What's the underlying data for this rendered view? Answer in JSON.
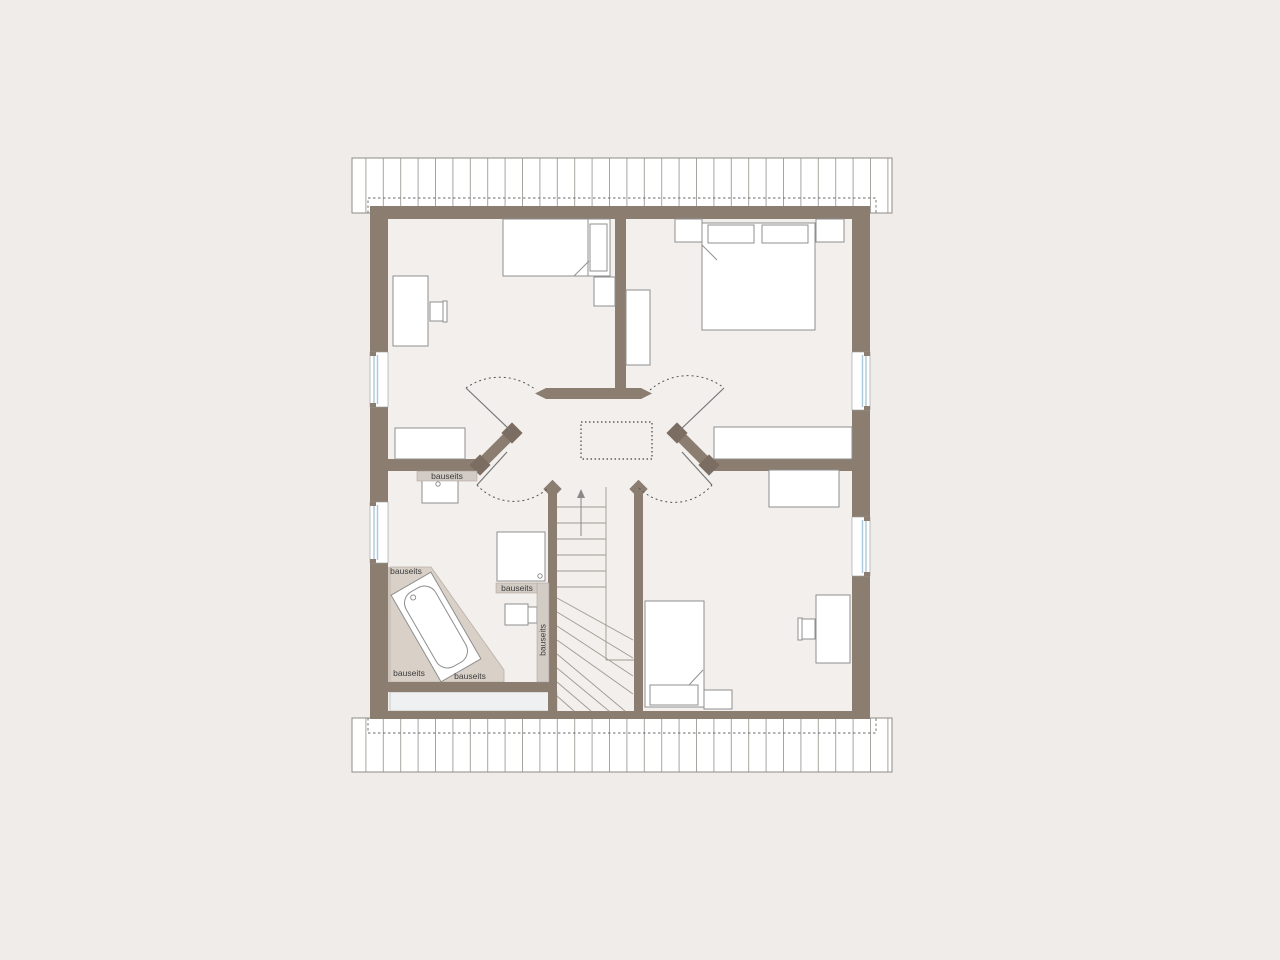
{
  "annotations": [
    {
      "text": "bauseits",
      "location": "shelf-under-left-room-wall",
      "orientation": "horizontal"
    },
    {
      "text": "bauseits",
      "location": "bathroom-left-knee-wall-top",
      "orientation": "horizontal"
    },
    {
      "text": "bauseits",
      "location": "band-under-shower",
      "orientation": "horizontal"
    },
    {
      "text": "bauseits",
      "location": "bathroom-right-duct",
      "orientation": "vertical"
    },
    {
      "text": "bauseits",
      "location": "bathroom-bottom-left",
      "orientation": "horizontal"
    },
    {
      "text": "bauseits",
      "location": "bathroom-bottom-center",
      "orientation": "horizontal"
    }
  ],
  "colors": {
    "background": "#f0ece9",
    "floor": "#f2efec",
    "wall": "#8b7d70",
    "knob": "#7b6d61",
    "knee": "#d9d1c8",
    "band": "#d3ccc5",
    "lining": "#cdc3b8",
    "glass": "#a9c9db",
    "outline": "#8f8f8f",
    "stair_line": "#a39a91",
    "text": "#3b3b3b"
  }
}
